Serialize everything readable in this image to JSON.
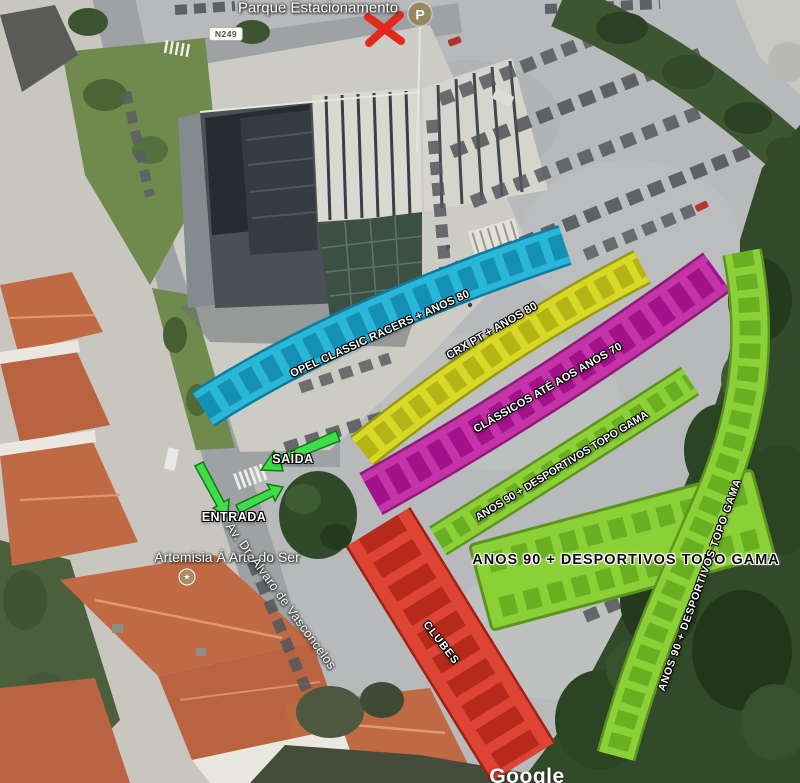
{
  "map": {
    "top_label": "Parque Estacionamento",
    "road_badge": "N249",
    "parking_icon_letter": "P",
    "watermark": "Google",
    "poi_name": "Artemisia Á Arte do Ser",
    "street_name": "Av. Dr. Álvaro de Vasconcelos",
    "arrows": {
      "exit_label": "SAÍDA",
      "entrance_label": "ENTRADA",
      "arrow_color": "#3fdd49"
    },
    "zones": [
      {
        "id": "opel",
        "label": "OPEL CLASSIC RACERS + ANOS 80",
        "color": "#29b6d8"
      },
      {
        "id": "crx",
        "label": "CRX PT + ANOS 80",
        "color": "#d8d826"
      },
      {
        "id": "classicos",
        "label": "CLÁSSICOS ATÉ AOS ANOS 70",
        "color": "#c433a7"
      },
      {
        "id": "anos90-row",
        "label": "ANOS 90 + DESPORTIVOS TOPO GAMA",
        "color": "#8cd038"
      },
      {
        "id": "anos90-block",
        "label": "ANOS 90 + DESPORTIVOS TOPO GAMA",
        "color": "#8cd038"
      },
      {
        "id": "anos90-curve",
        "label": "ANOS 90 + DESPORTIVOS TOPO GAMA",
        "color": "#8cd038"
      },
      {
        "id": "clubes",
        "label": "CLUBES",
        "color": "#dd4433"
      }
    ],
    "status": {
      "closed_marker_color": "#e3281c"
    }
  }
}
